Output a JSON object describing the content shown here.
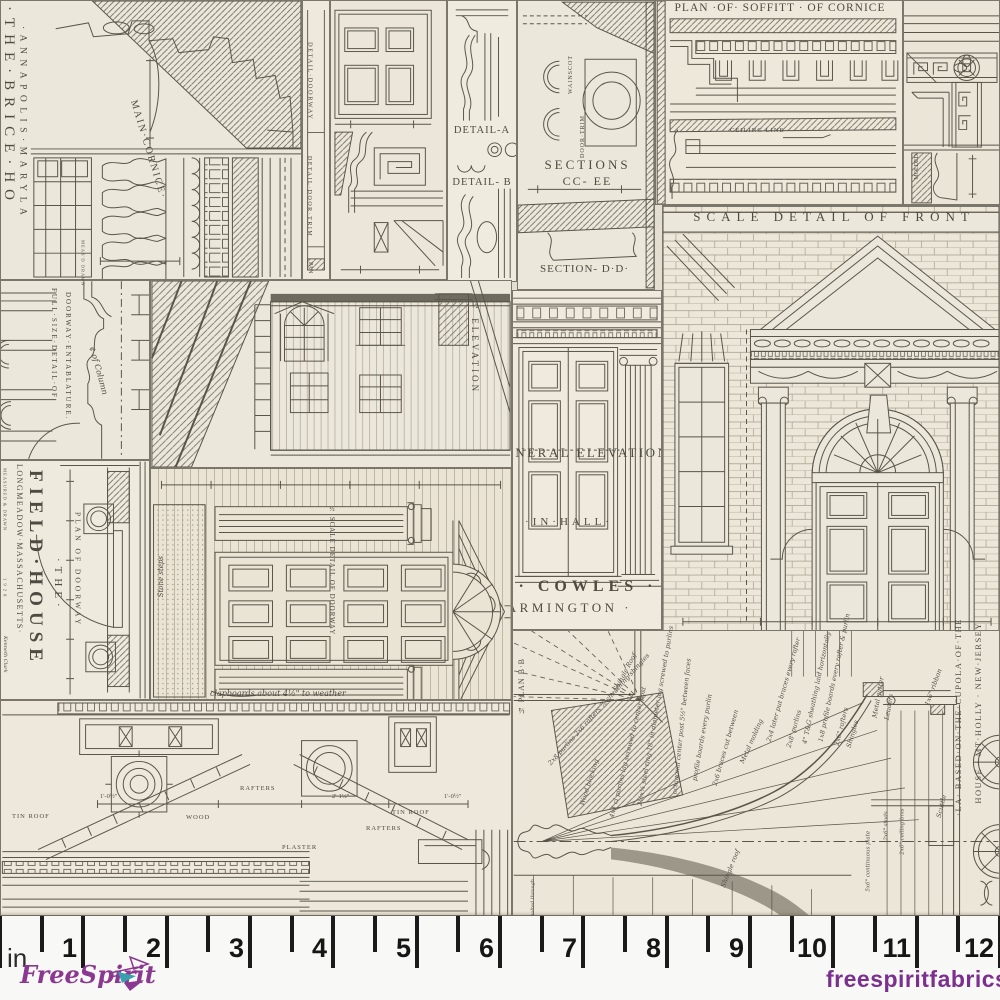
{
  "colors": {
    "cream": "#ece7db",
    "line": "#5a5549",
    "dark": "#6f6a60",
    "logo_purple": "#8b3990",
    "logo_teal": "#3a9fae",
    "website_purple": "#7b2f8e",
    "ruler_bg": "#f8f8f6",
    "tick": "#1b1b1b"
  },
  "panels": {
    "brice": {
      "title": "·THE·BRICE·HO",
      "subtitle": "·ANNAPOLIS·MARYLA",
      "cornice_label": "MAIN·CORNICE·",
      "credit": "MEAS'D DRAWN"
    },
    "trim_strip": {
      "line1": "DETAIL·DOORWAY",
      "line2": "DETAIL·DOOR·TRIM",
      "line3": "PAN"
    },
    "details": {
      "a": "DETAIL-A",
      "b": "DETAIL- B",
      "sections": "SECTIONS",
      "sections2": "CC- EE",
      "section_dd": "SECTION- D·D·",
      "wainscot": "WAINSCOT",
      "door_trim": "DOOR·TRIM"
    },
    "soffit": {
      "title": "PLAN ·OF· SOFFITT · OF CORNICE",
      "ceiling": "CEILING LINE",
      "molded": "MOLDED·"
    },
    "front": {
      "title": "SCALE DETAIL OF FRONT"
    },
    "cowles": {
      "elevation": "GENERAL ELEVATION",
      "hall": "·IN·HALL·",
      "name": "· COWLES ·",
      "town": "FARMINGTON ·"
    },
    "entablature": {
      "title1": "FULL·SIZE·DETAIL·OF",
      "title2": "DOORWAY·ENTABLATURE.",
      "centerline": "¢ of Column"
    },
    "house_elevation": {
      "label": "½ ELEVATION"
    },
    "field_house": {
      "the": "·THE·",
      "name": "FIELD·HOUSE",
      "location": "LONGMEADOW·MASSACHUSETTS·",
      "plan": "PLAN OF DOORWAY",
      "measured": "MEASURED & DRAWN",
      "year": "1 9 2 8",
      "credit": "Kenneth Clark"
    },
    "doorway": {
      "label": "½ SCALE DETAIL OF DOORWAY",
      "stone": "Stone steps",
      "note": "clapboards about 4½\" to weather"
    },
    "roof_details": {
      "labels": [
        "TIN ROOF",
        "WOOD",
        "RAFTERS",
        "TIN ROOF",
        "RAFTERS",
        "PLASTER"
      ],
      "dims": [
        "1'-0½\"",
        "2'-1¼\"",
        "1'-0½\""
      ]
    },
    "cupola": {
      "plan": "¼ PLAN B·B",
      "title1": "·LA· BASED·ON·THE·CUPOLA·OF·THE",
      "title2": "HOUSE · MT·HOLLY · NEW·JERSEY",
      "notes": [
        "Shingle Roof",
        "2x8 purlins  2x6 rafters  ⅞ sheathing  shingles",
        "Wood blocking",
        "4x4 cl purlins lag screwed to center post",
        "2½x¼ steel ring 18\" in diameter lag screwed to purlins",
        "octagonal center post 5½\" between faces",
        "profile boards every purlin",
        "2x6 braces cut between",
        "Metal molding",
        "Steel strap 3/16x2 over center post bolted through",
        "2x4 later put braces every rafter",
        "2x8' purlins",
        "4\" T&G sheathing laid horizontally",
        "1x8 profile boards every rafter & purlin",
        "2x6\" rafters",
        "Shingles",
        "Metal gutter",
        "Leaders",
        "1x6\" ribbon",
        "2x6\" ceiling bms",
        "2x6\" studs",
        "5x6\" continuous plate",
        "Scuttle",
        "Shingle roof"
      ]
    }
  },
  "ruler": {
    "unit": "in",
    "numbers": [
      "1",
      "2",
      "3",
      "4",
      "5",
      "6",
      "7",
      "8",
      "9",
      "10",
      "11",
      "12"
    ]
  },
  "brand": {
    "logo": "FreeSpirit",
    "website": "freespiritfabrics.com"
  }
}
